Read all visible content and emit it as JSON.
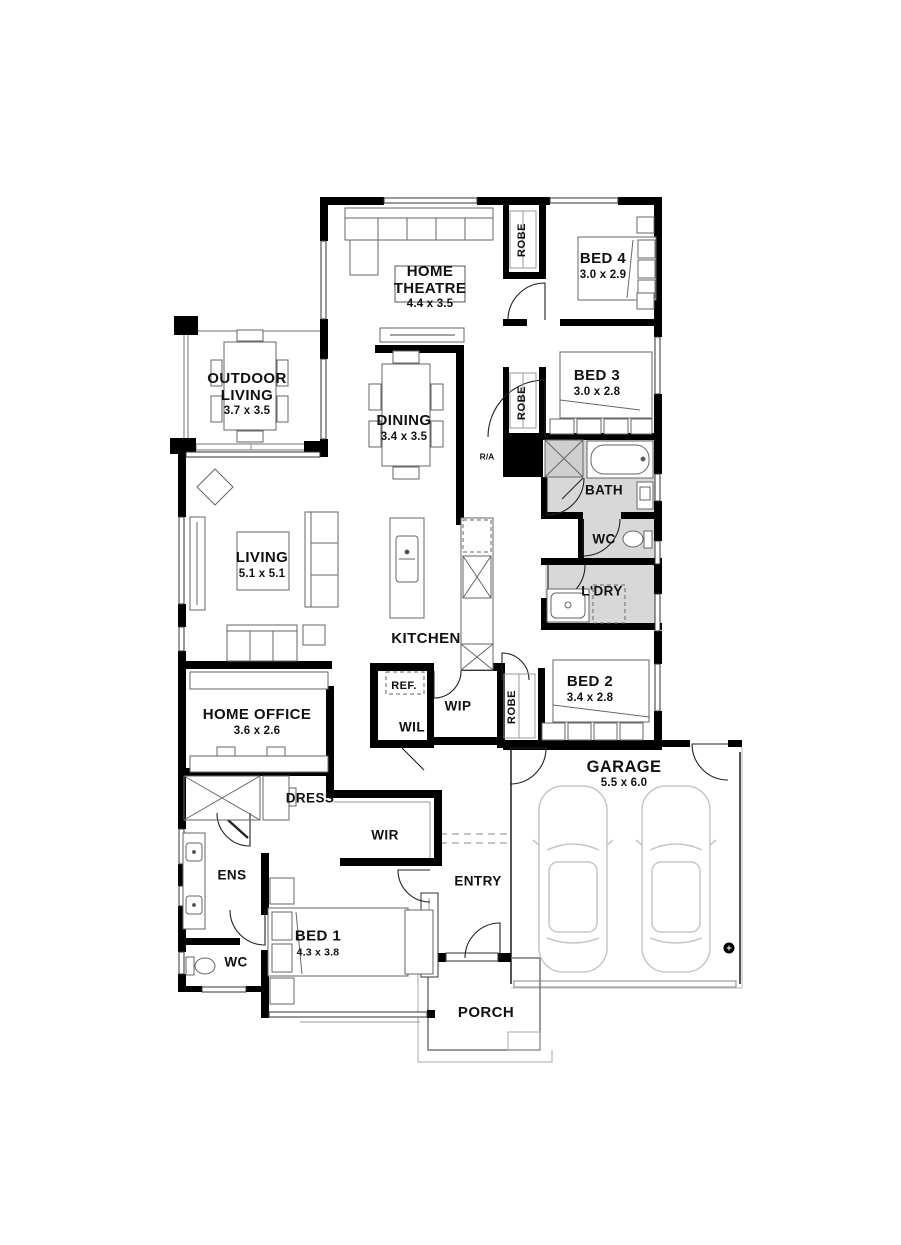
{
  "colors": {
    "wall": "#000000",
    "wet_area_fill": "#d8d8d8",
    "furniture_line": "#666666",
    "thin_line": "#8a8a8a",
    "car_line": "#c6c6c6",
    "text": "#111111"
  },
  "plan": {
    "home_theatre": {
      "name": "HOME",
      "name2": "THEATRE",
      "dims": "4.4 x 3.5"
    },
    "bed4": {
      "name": "BED 4",
      "dims": "3.0 x 2.9"
    },
    "bed3": {
      "name": "BED 3",
      "dims": "3.0 x 2.8"
    },
    "outdoor_living": {
      "name": "OUTDOOR",
      "name2": "LIVING",
      "dims": "3.7 x 3.5"
    },
    "dining": {
      "name": "DINING",
      "dims": "3.4 x 3.5"
    },
    "bath": {
      "name": "BATH"
    },
    "wc": {
      "name": "WC"
    },
    "ldry": {
      "name": "L'DRY"
    },
    "living": {
      "name": "LIVING",
      "dims": "5.1 x 5.1"
    },
    "kitchen": {
      "name": "KITCHEN"
    },
    "bed2": {
      "name": "BED 2",
      "dims": "3.4 x 2.8"
    },
    "home_office": {
      "name": "HOME OFFICE",
      "dims": "3.6 x 2.6"
    },
    "ref": {
      "name": "REF."
    },
    "wip": {
      "name": "WIP"
    },
    "wil": {
      "name": "WIL"
    },
    "robe1": {
      "name": "ROBE"
    },
    "robe2": {
      "name": "ROBE"
    },
    "robe3": {
      "name": "ROBE"
    },
    "ra": {
      "name": "R/A"
    },
    "garage": {
      "name": "GARAGE",
      "dims": "5.5 x 6.0"
    },
    "dress": {
      "name": "DRESS"
    },
    "wir": {
      "name": "WIR"
    },
    "ens": {
      "name": "ENS"
    },
    "wc2": {
      "name": "WC"
    },
    "bed1": {
      "name": "BED 1",
      "dims": "4.3 x 3.8"
    },
    "entry": {
      "name": "ENTRY"
    },
    "porch": {
      "name": "PORCH"
    }
  }
}
